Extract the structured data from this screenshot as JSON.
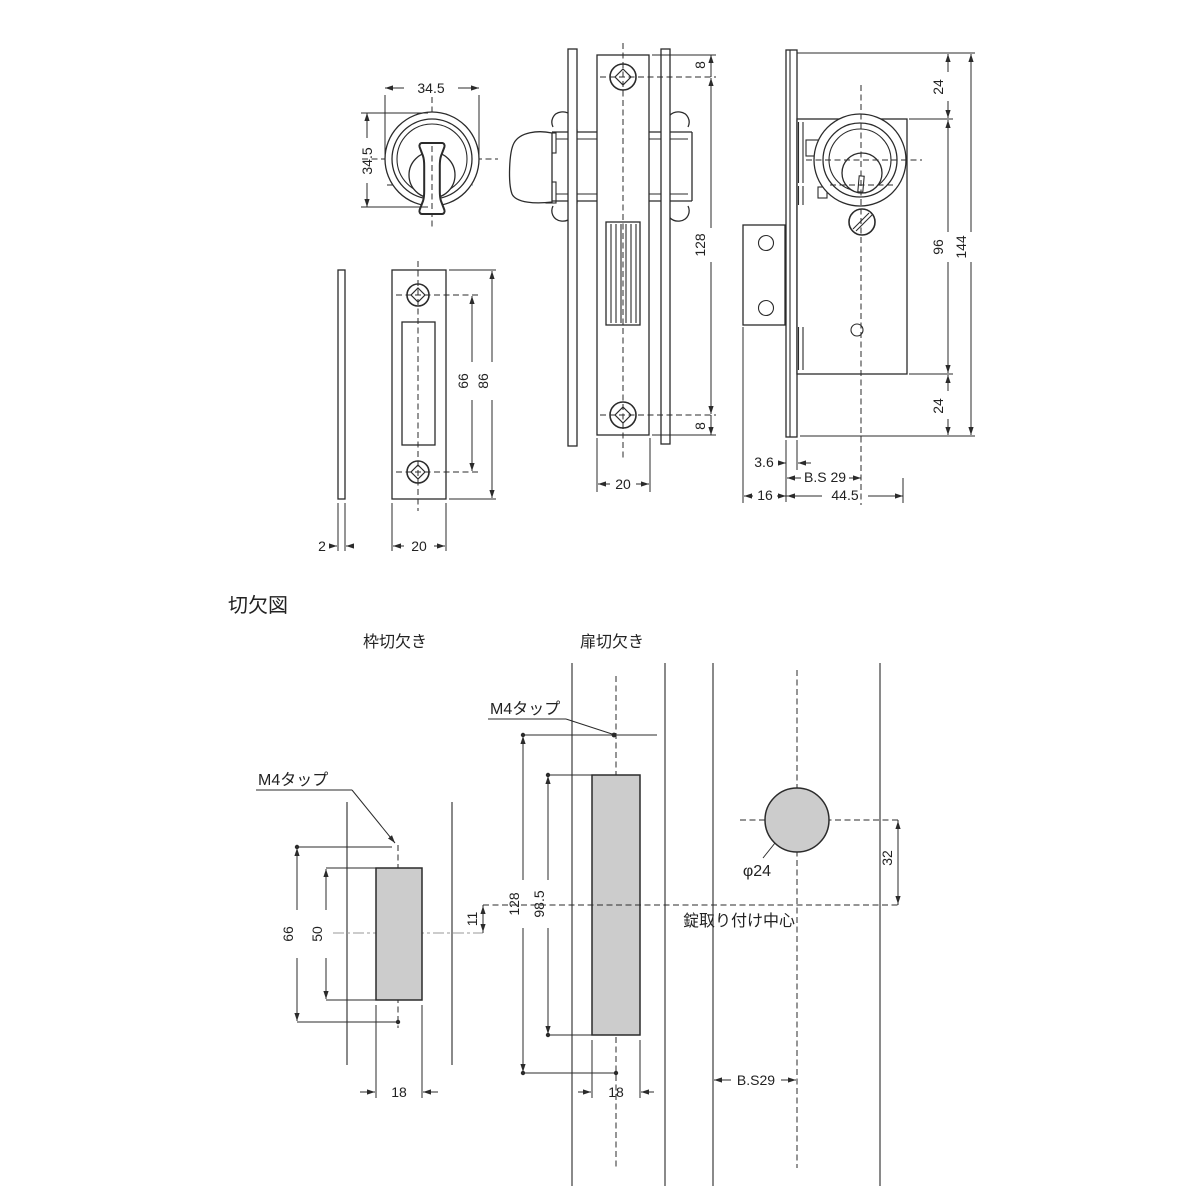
{
  "colors": {
    "line": "#2b2b2b",
    "gray_fill": "#cccccc",
    "center_gray": "#9a9a9a"
  },
  "heading": {
    "title": "切欠図"
  },
  "views": {
    "knob": {
      "dim_w": "34.5",
      "dim_h": "34.5"
    },
    "side": {
      "dim_top": "8",
      "dim_body": "128",
      "dim_bot": "8",
      "dim_w": "20"
    },
    "front": {
      "dim_top": "24",
      "dim_mid": "96",
      "dim_total": "144",
      "dim_bot": "24",
      "dim_plate": "3.6",
      "dim_backset": "B.S 29",
      "dim_tab": "16",
      "dim_depth": "44.5"
    },
    "strike": {
      "dim_holes": "66",
      "dim_h": "86",
      "dim_w": "20",
      "dim_t": "2"
    }
  },
  "cutout": {
    "frame": {
      "label": "枠切欠き",
      "tap": "M4タップ",
      "dim_outer": "66",
      "dim_inner": "50",
      "dim_w": "18",
      "dim_offset": "11"
    },
    "door": {
      "label": "扉切欠き",
      "tap": "M4タップ",
      "dim_outer": "128",
      "dim_inner": "98.5",
      "dim_w": "18"
    },
    "edge": {
      "dim_dia": "φ24",
      "dim_offset": "32",
      "dim_backset": "B.S29",
      "note": "錠取り付け中心"
    }
  }
}
